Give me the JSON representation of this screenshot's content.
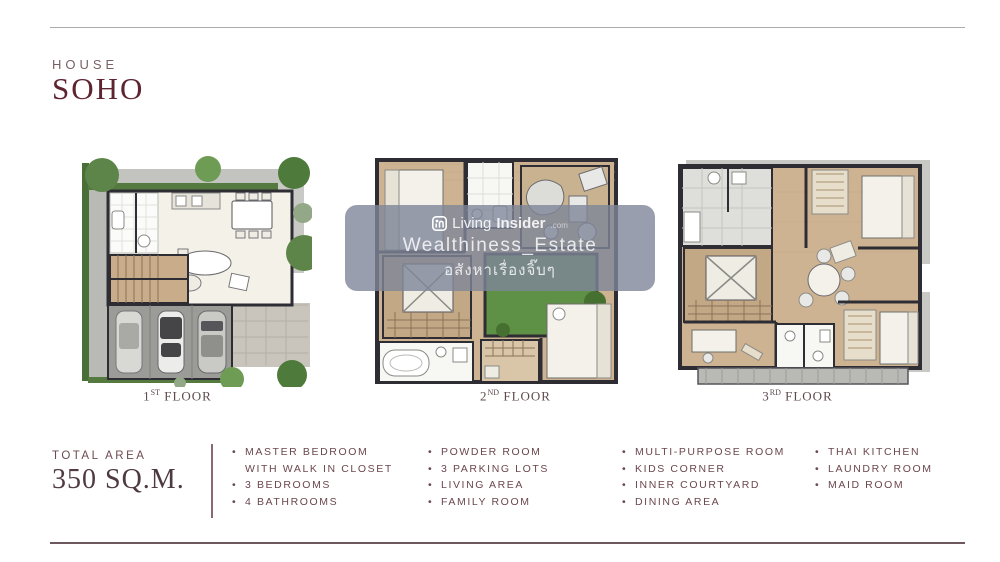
{
  "header": {
    "subtitle": "HOUSE",
    "title": "SOHO"
  },
  "floors": [
    {
      "num": "1",
      "ord": "ST",
      "word": "FLOOR"
    },
    {
      "num": "2",
      "ord": "ND",
      "word": "FLOOR"
    },
    {
      "num": "3",
      "ord": "RD",
      "word": "FLOOR"
    }
  ],
  "total_area": {
    "label": "TOTAL AREA",
    "value": "350 SQ.M."
  },
  "features": {
    "col1": [
      {
        "text": "MASTER BEDROOM"
      },
      {
        "text": "WITH WALK IN CLOSET"
      },
      {
        "text": "3 BEDROOMS"
      },
      {
        "text": "4 BATHROOMS"
      }
    ],
    "col2": [
      {
        "text": "POWDER ROOM"
      },
      {
        "text": "3 PARKING LOTS"
      },
      {
        "text": "LIVING AREA"
      },
      {
        "text": "FAMILY ROOM"
      }
    ],
    "col3": [
      {
        "text": "MULTI-PURPOSE ROOM"
      },
      {
        "text": "KIDS CORNER"
      },
      {
        "text": "INNER COURTYARD"
      },
      {
        "text": "DINING AREA"
      }
    ],
    "col4": [
      {
        "text": "THAI KITCHEN"
      },
      {
        "text": "LAUNDRY ROOM"
      },
      {
        "text": "MAID ROOM"
      }
    ]
  },
  "watermark": {
    "brand_prefix": "Living",
    "brand_bold": "Insider",
    "brand_suffix": ".com",
    "line2": "Wealthiness_Estate",
    "line3": "อสังหาเรื่องจิ๊บๆ"
  },
  "colors": {
    "brand_maroon": "#5e2430",
    "feature_text": "#6b474e",
    "watermark_bg": "#7e8698",
    "wood_floor": "#cdb392",
    "grass_green": "#5e9046",
    "wall_dark": "#2e2d33",
    "concrete_gray": "#b9bab6"
  }
}
